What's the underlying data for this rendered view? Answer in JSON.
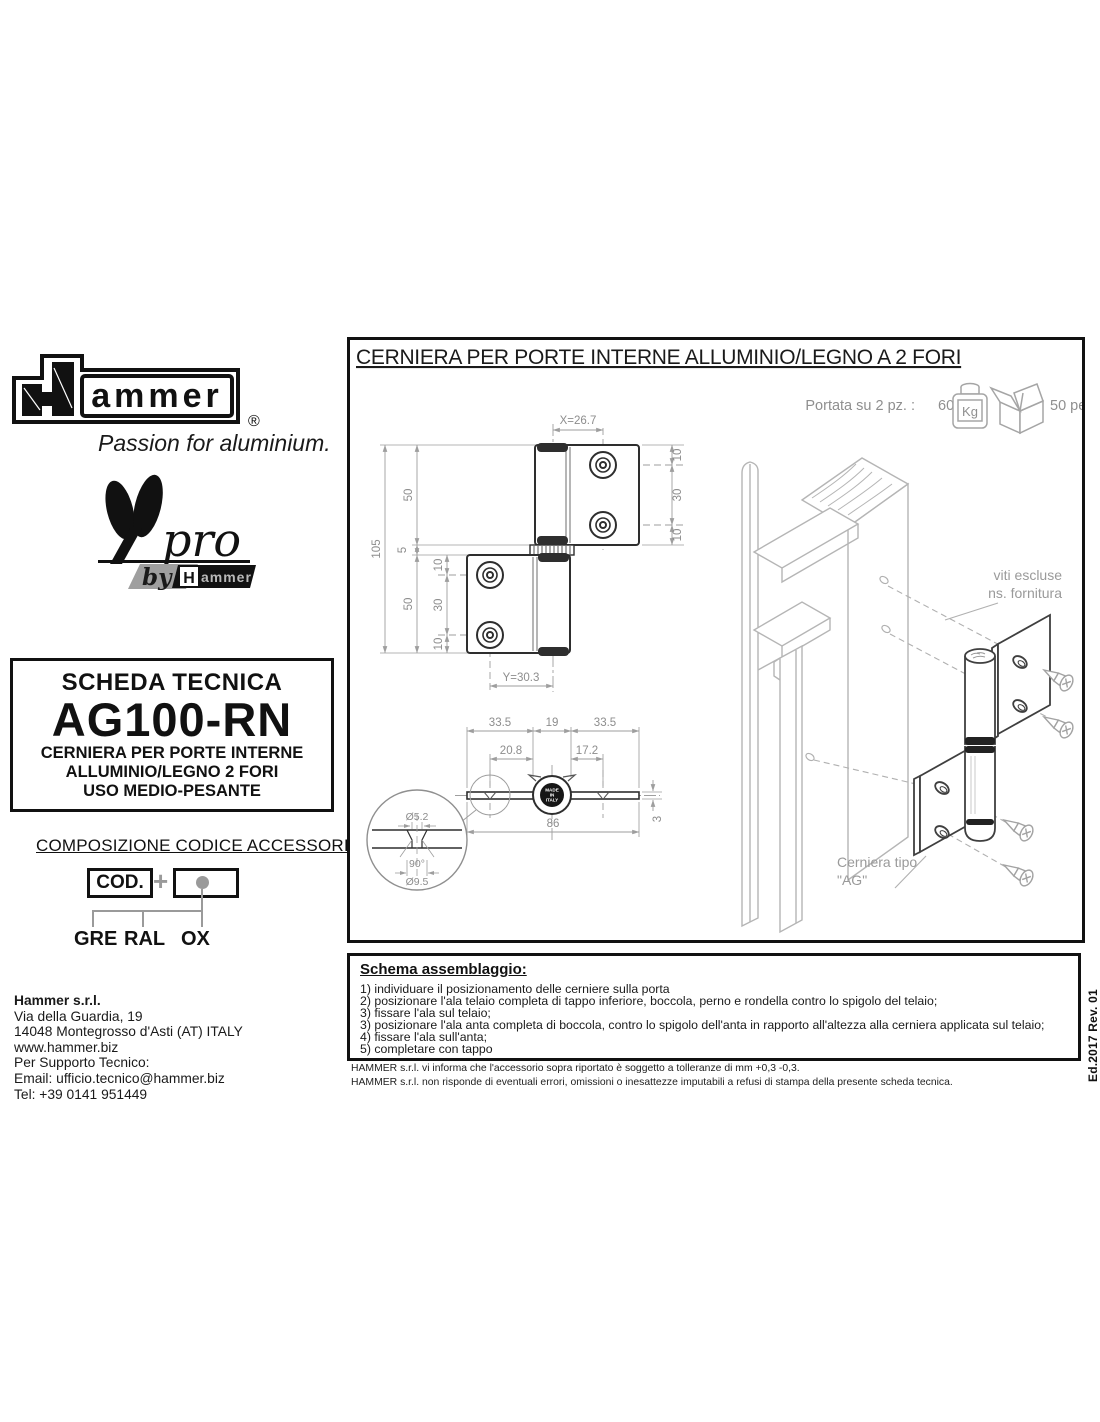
{
  "colors": {
    "line_dark": "#2e2e2e",
    "line_dim": "#9e9e9e",
    "line_light": "#b5b5b5",
    "text_gray": "#8d8d8d",
    "black": "#111111"
  },
  "branding": {
    "logo_word": "ammer",
    "logo_registered": "®",
    "tagline": "Passion for aluminium.",
    "apro": {
      "a": "A",
      "pro": "pro",
      "by": "by",
      "h": "H",
      "hammer_word": "ammer"
    }
  },
  "tech_sheet": {
    "header": "SCHEDA TECNICA",
    "code": "AG100-RN",
    "desc1": "CERNIERA PER PORTE INTERNE",
    "desc2": "ALLUMINIO/LEGNO 2 FORI",
    "desc3": "USO MEDIO-PESANTE"
  },
  "code_composition": {
    "title": "COMPOSIZIONE CODICE ACCESSORI",
    "cod": "COD.",
    "plus": "+",
    "options": [
      "GRE",
      "RAL",
      "OX"
    ]
  },
  "company": {
    "name": "Hammer s.r.l.",
    "address1": "Via della Guardia, 19",
    "address2": "14048 Montegrosso d'Asti (AT) ITALY",
    "website": "www.hammer.biz",
    "support": "Per Supporto Tecnico:",
    "email": "Email: ufficio.tecnico@hammer.biz",
    "phone": "Tel: +39 0141 951449"
  },
  "panel": {
    "title": "CERNIERA PER PORTE INTERNE ALLUMINIO/LEGNO A 2 FORI",
    "capacity_label": "Portata su 2 pz. :",
    "capacity_value": "60",
    "capacity_unit": "Kg",
    "package_qty": "50 pezzi",
    "notes": {
      "screws1": "viti escluse",
      "screws2": "ns. fornitura",
      "hinge1": "Cerniera tipo",
      "hinge2": "\"AG\""
    },
    "front_view": {
      "dim_x": "X=26.7",
      "total_h": "105",
      "upper": "50",
      "gap": "5",
      "lower": "50",
      "t1": "10",
      "t2": "30",
      "t3": "10",
      "b1": "10",
      "b2": "30",
      "b3": "10",
      "dim_y": "Y=30.3"
    },
    "section_view": {
      "left": "33.5",
      "center": "19",
      "right": "33.5",
      "hole_left": "20.8",
      "hole_right": "17.2",
      "total": "86",
      "thickness": "3",
      "detail_hole": "Ø5.2",
      "detail_angle": "90°",
      "detail_outer": "Ø9.5",
      "stamp1": "MADE",
      "stamp2": "IN",
      "stamp3": "ITALY"
    }
  },
  "assembly": {
    "title": "Schema assemblaggio:",
    "steps": [
      "1) individuare il posizionamento delle cerniere sulla porta",
      "2) posizionare l'ala telaio completa di tappo inferiore, boccola, perno e rondella contro lo spigolo del telaio;",
      "3) fissare l'ala sul telaio;",
      "3) posizionare l'ala anta completa di boccola, contro lo spigolo dell'anta in rapporto all'altezza alla cerniera applicata sul telaio;",
      "4) fissare l'ala sull'anta;",
      "5) completare con tappo"
    ]
  },
  "footnotes": [
    "HAMMER s.r.l. vi informa che l'accessorio sopra riportato è soggetto a tolleranze di mm +0,3 -0,3.",
    "HAMMER s.r.l. non risponde di eventuali errori, omissioni o inesattezze imputabili a refusi di stampa della presente scheda tecnica."
  ],
  "edition": "Ed.2017 Rev. 01"
}
